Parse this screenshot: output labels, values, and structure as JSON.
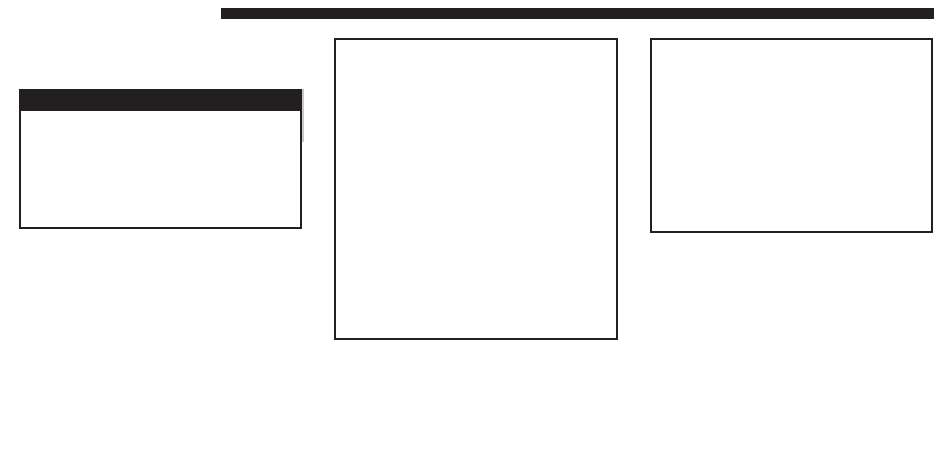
{
  "colors": {
    "ink": "#231f20",
    "paper": "#ffffff",
    "shadow": "#c9c7c8"
  },
  "top_rule": {
    "label": ""
  },
  "left_panel": {
    "header_text": "",
    "body_text": ""
  },
  "center_panel": {
    "body_text": ""
  },
  "right_panel": {
    "body_text": ""
  }
}
